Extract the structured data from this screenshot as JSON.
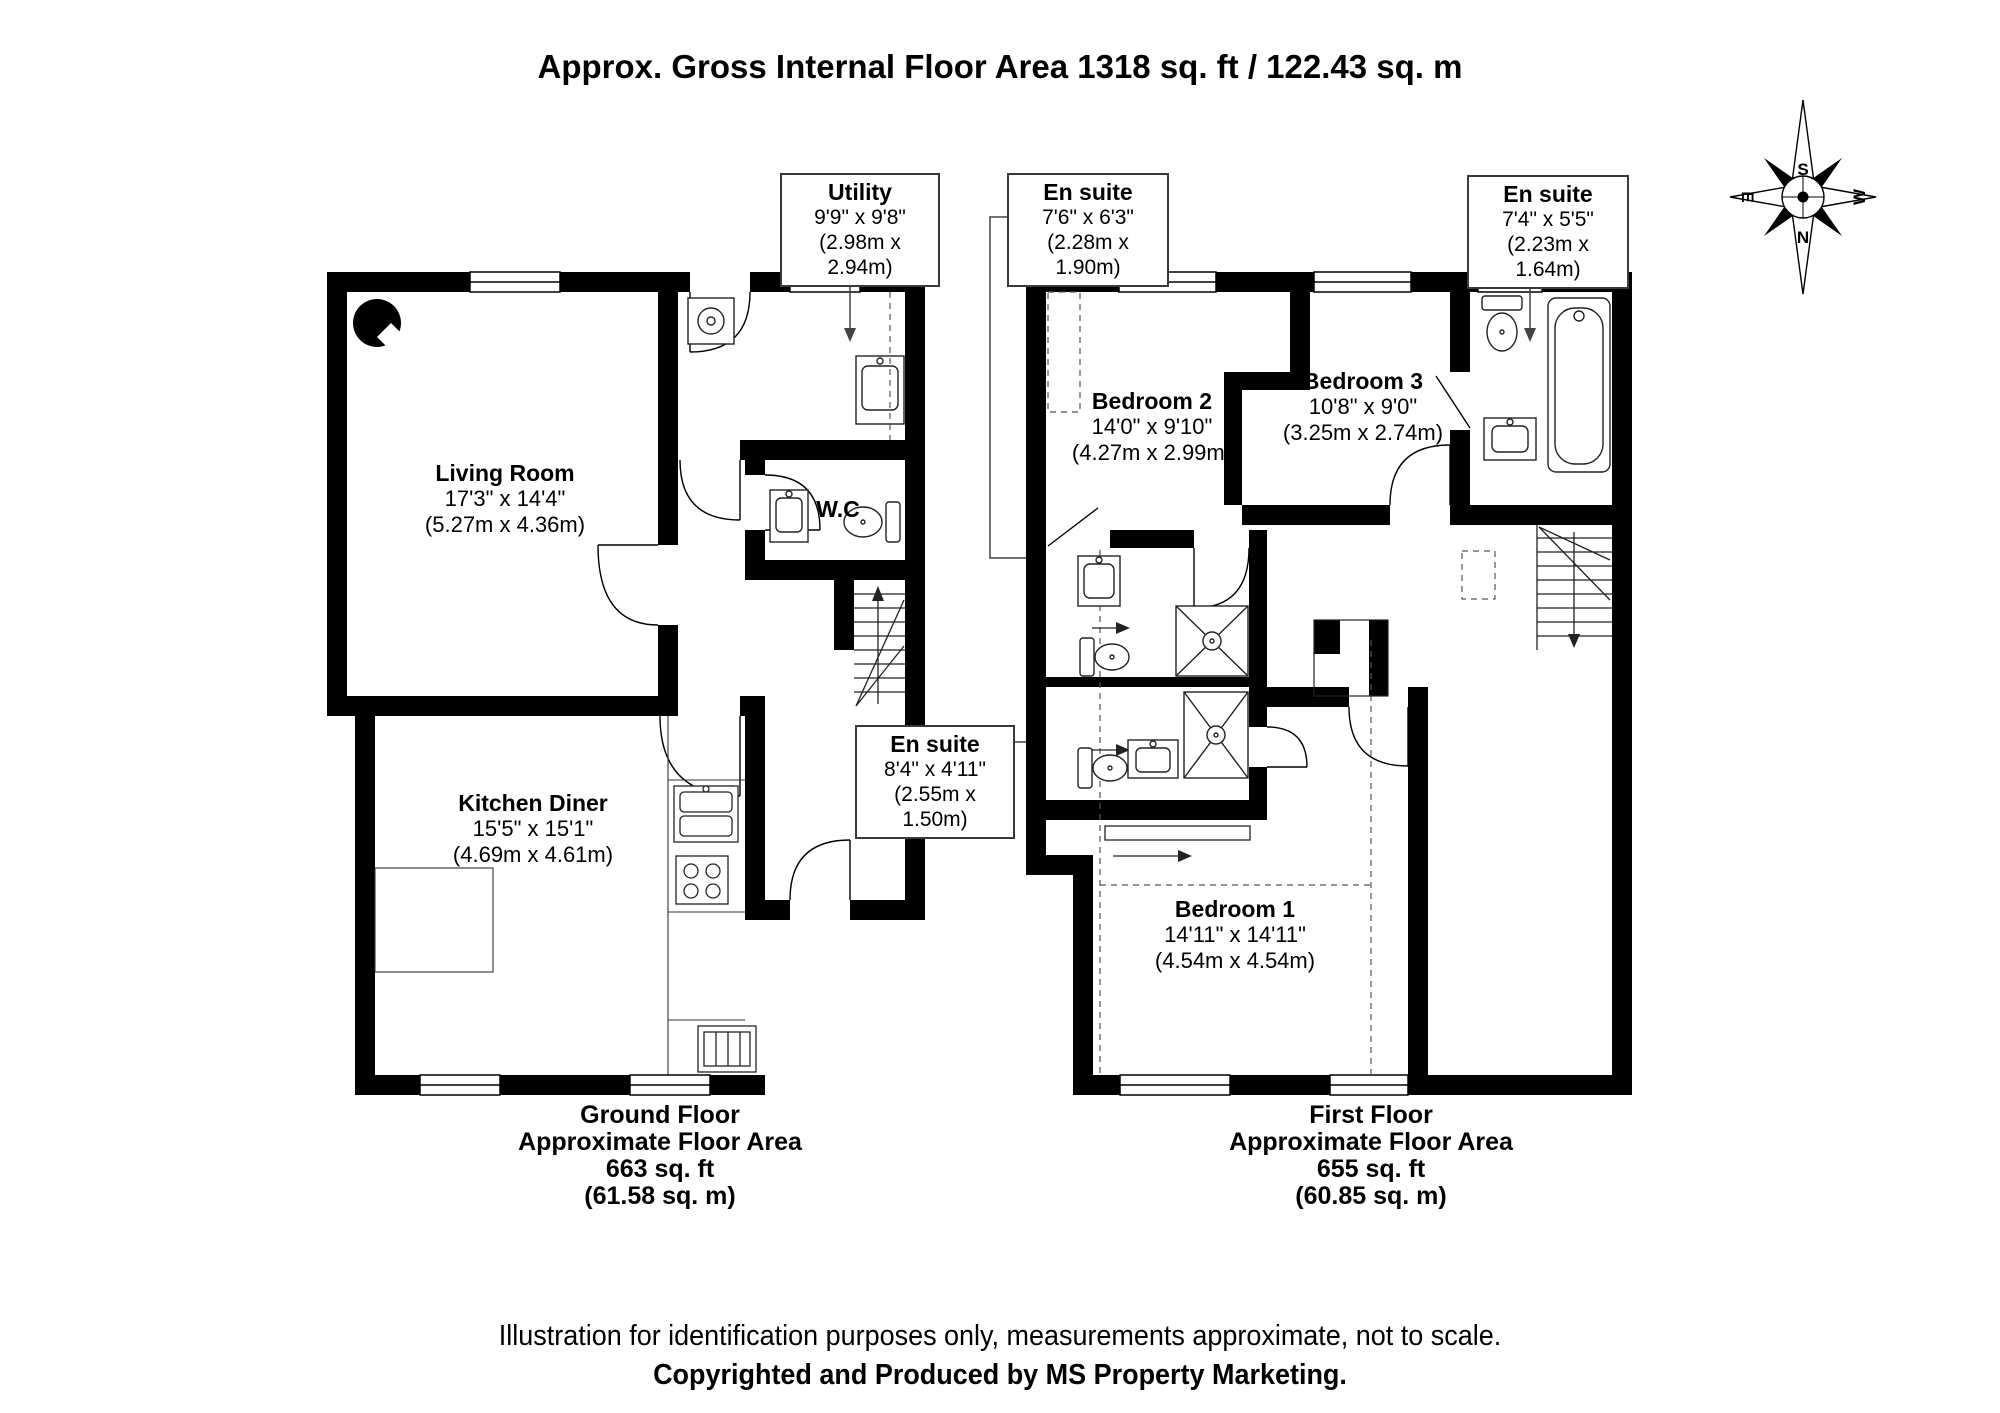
{
  "title": "Approx. Gross Internal Floor Area 1318 sq. ft / 122.43 sq. m",
  "compass": {
    "top": "S",
    "bottom": "N",
    "left": "E",
    "right": "W"
  },
  "ground_floor": {
    "rooms": {
      "living_room": {
        "name": "Living Room",
        "imperial": "17'3\" x 14'4\"",
        "metric": "(5.27m x 4.36m)"
      },
      "kitchen_diner": {
        "name": "Kitchen Diner",
        "imperial": "15'5\" x 15'1\"",
        "metric": "(4.69m x 4.61m)"
      },
      "wc": {
        "name": "W.C"
      }
    },
    "callouts": {
      "utility": {
        "name": "Utility",
        "imperial": "9'9\" x 9'8\"",
        "metric": "(2.98m x 2.94m)"
      }
    },
    "footer": {
      "floor": "Ground Floor",
      "label": "Approximate Floor Area",
      "sqft": "663 sq. ft",
      "sqm": "(61.58 sq. m)"
    }
  },
  "first_floor": {
    "rooms": {
      "bedroom_1": {
        "name": "Bedroom 1",
        "imperial": "14'11\" x 14'11\"",
        "metric": "(4.54m x 4.54m)"
      },
      "bedroom_2": {
        "name": "Bedroom 2",
        "imperial": "14'0\" x 9'10\"",
        "metric": "(4.27m x 2.99m)"
      },
      "bedroom_3": {
        "name": "Bedroom 3",
        "imperial": "10'8\" x 9'0\"",
        "metric": "(3.25m x 2.74m)"
      }
    },
    "callouts": {
      "ensuite_top_left": {
        "name": "En suite",
        "imperial": "7'6\" x 6'3\"",
        "metric": "(2.28m x 1.90m)"
      },
      "ensuite_top_right": {
        "name": "En suite",
        "imperial": "7'4\" x 5'5\"",
        "metric": "(2.23m x 1.64m)"
      },
      "ensuite_middle": {
        "name": "En suite",
        "imperial": "8'4\" x 4'11\"",
        "metric": "(2.55m x 1.50m)"
      }
    },
    "footer": {
      "floor": "First Floor",
      "label": "Approximate Floor Area",
      "sqft": "655 sq. ft",
      "sqm": "(60.85 sq. m)"
    }
  },
  "disclaimer": {
    "line1": "Illustration for identification purposes only, measurements approximate, not to scale.",
    "line2": "Copyrighted  and Produced by MS Property Marketing."
  }
}
